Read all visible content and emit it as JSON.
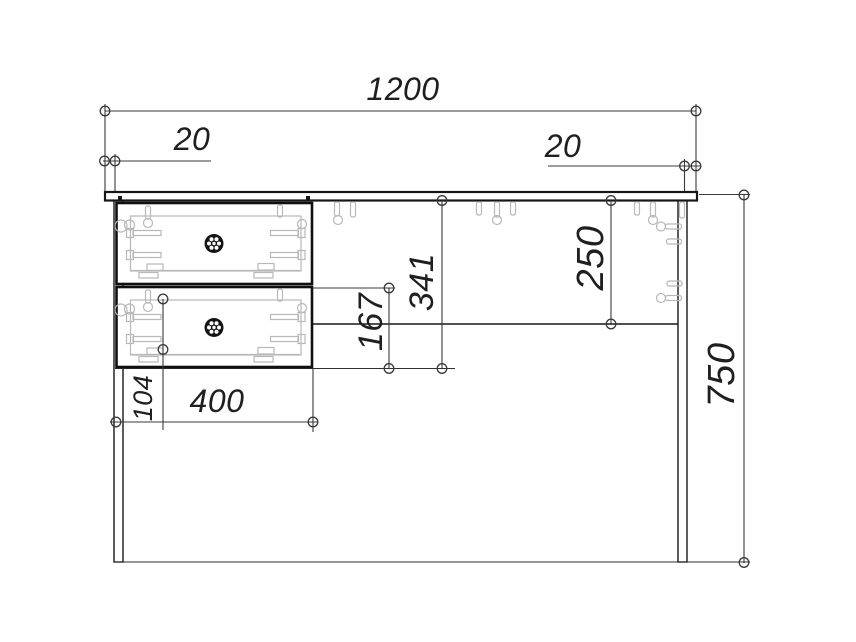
{
  "drawing": {
    "dims": {
      "total_width": "1200",
      "left_overhang": "20",
      "right_overhang": "20",
      "total_height": "750",
      "back_panel_height": "250",
      "drawer_bay_height": "341",
      "lower_section_height": "167",
      "drawer_unit_width": "400",
      "drawer_hole_pitch": "104"
    },
    "colors": {
      "outline": "#161616",
      "dimension_lines": "#3a3a3a",
      "hidden_details": "#b8b8b8",
      "background": "#ffffff"
    }
  }
}
